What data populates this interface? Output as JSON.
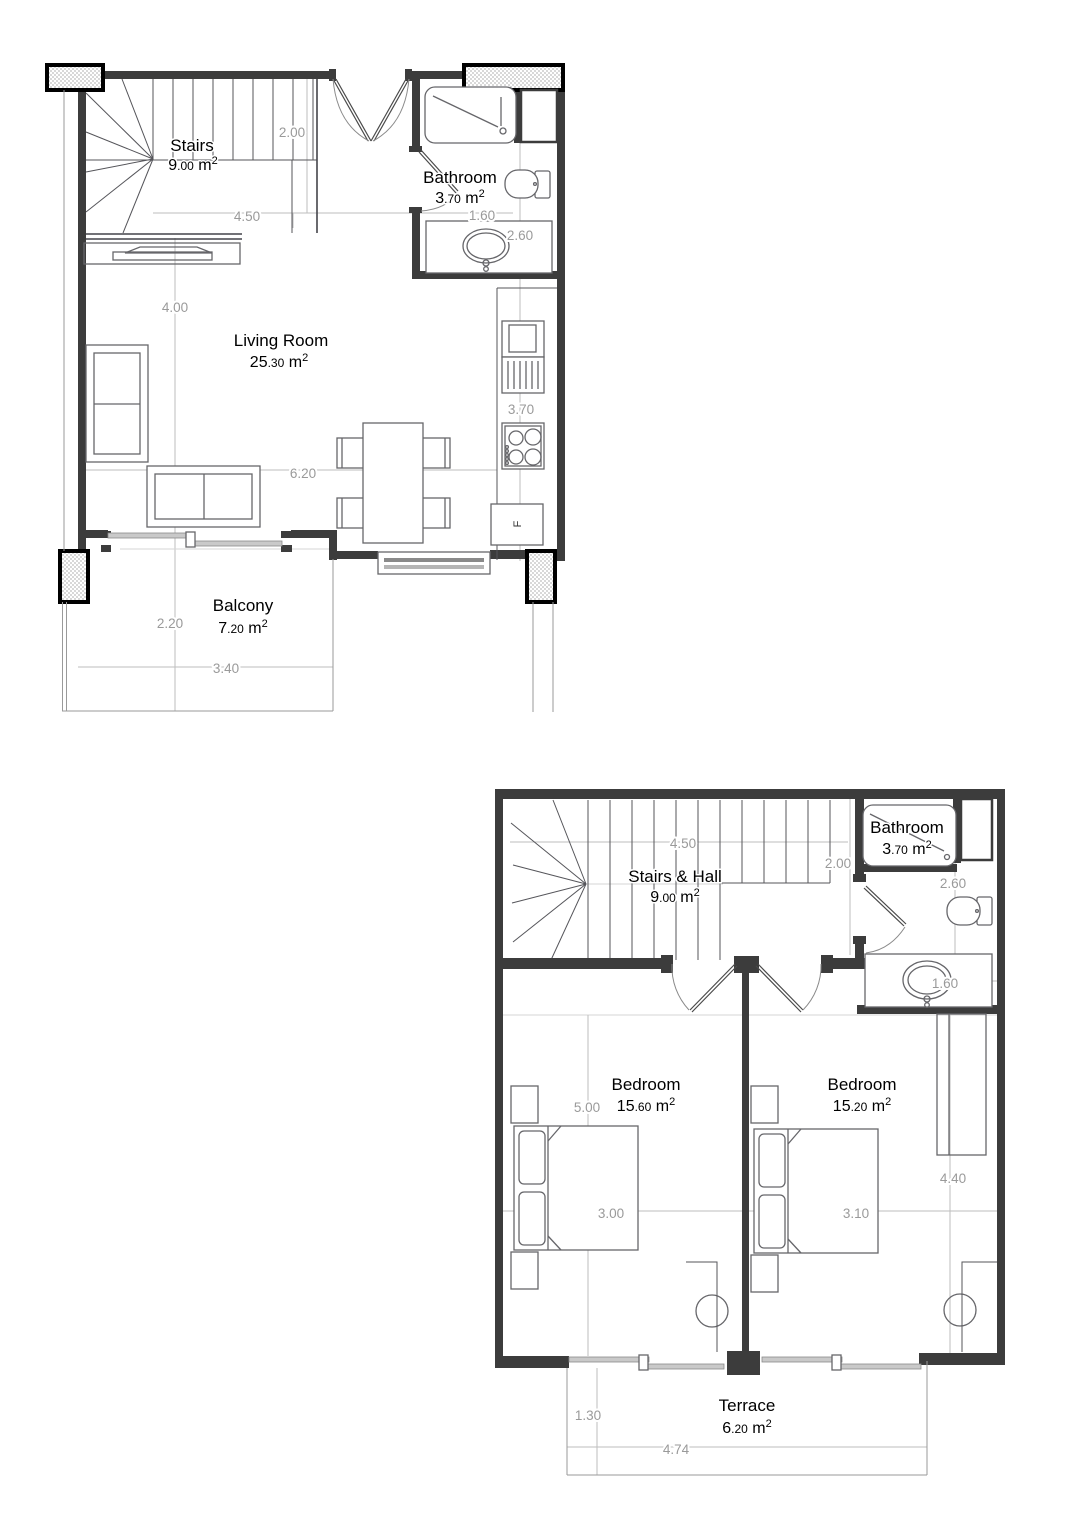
{
  "title": "Two-storey apartment floor plan",
  "colors": {
    "wall": "#3c3c3c",
    "dimension": "#9a9a9a",
    "label": "#000000",
    "light_line": "#bdbdbd"
  },
  "unit": {
    "m": " m",
    "sup": "2"
  },
  "floor1": {
    "stairs": {
      "name": "Stairs",
      "area_int": "9",
      "area_dec": ".00"
    },
    "bathroom": {
      "name": "Bathroom",
      "area_int": "3",
      "area_dec": ".70"
    },
    "living_room": {
      "name": "Living Room",
      "area_int": "25",
      "area_dec": ".30"
    },
    "balcony": {
      "name": "Balcony",
      "area_int": "7",
      "area_dec": ".20"
    },
    "fridge": "F",
    "dims": {
      "hall_width": "2.00",
      "stairs_width": "4.50",
      "bath_width": "1.60",
      "bath_depth": "2.60",
      "living_height": "4.00",
      "kitchen_depth": "3.70",
      "living_width": "6.20",
      "balcony_depth": "2.20",
      "balcony_width": "3.40"
    }
  },
  "floor2": {
    "stairs_hall": {
      "name": "Stairs & Hall",
      "area_int": "9",
      "area_dec": ".00"
    },
    "bathroom": {
      "name": "Bathroom",
      "area_int": "3",
      "area_dec": ".70"
    },
    "bedroom1": {
      "name": "Bedroom",
      "area_int": "15",
      "area_dec": ".60"
    },
    "bedroom2": {
      "name": "Bedroom",
      "area_int": "15",
      "area_dec": ".20"
    },
    "terrace": {
      "name": "Terrace",
      "area_int": "6",
      "area_dec": ".20"
    },
    "dims": {
      "stairs_width": "4.50",
      "hall_width": "2.00",
      "bath_depth": "2.60",
      "bath_width": "1.60",
      "bedroom1_height": "5.00",
      "bedroom1_width": "3.00",
      "bedroom2_width": "3.10",
      "bedroom2_height": "4.40",
      "terrace_depth": "1.30",
      "terrace_width": "4.74"
    }
  }
}
